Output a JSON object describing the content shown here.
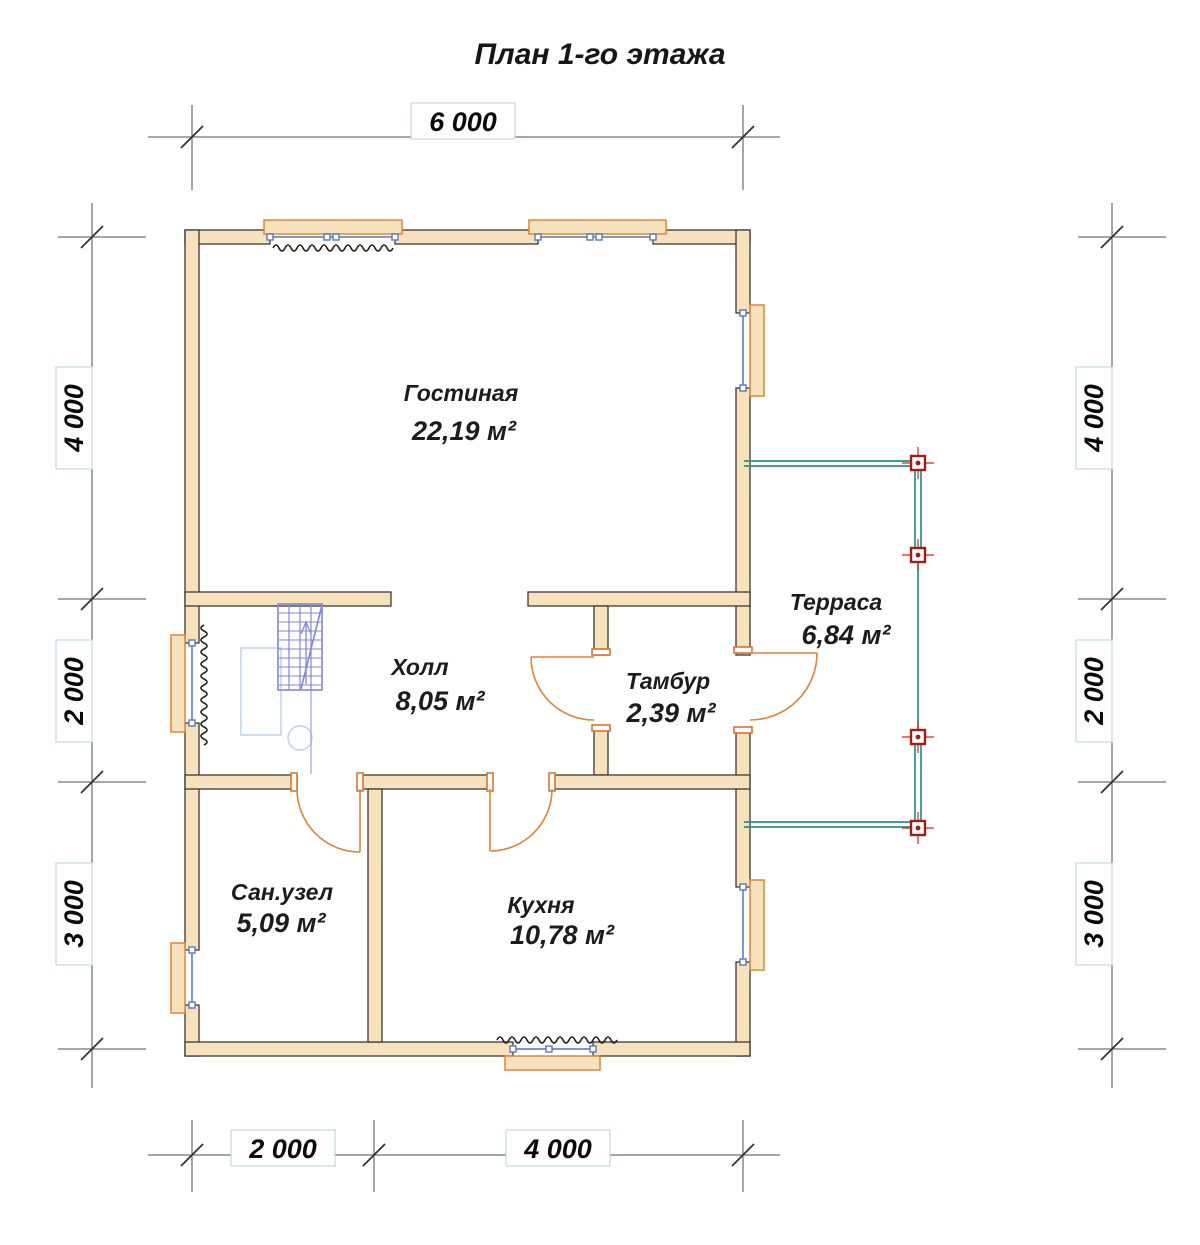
{
  "title": "План 1-го этажа",
  "rooms": {
    "living": {
      "name": "Гостиная",
      "area": "22,19 м²"
    },
    "hall": {
      "name": "Холл",
      "area": "8,05 м²"
    },
    "vestibule": {
      "name": "Тамбур",
      "area": "2,39 м²"
    },
    "terrace": {
      "name": "Терраса",
      "area": "6,84 м²"
    },
    "bathroom": {
      "name": "Сан.узел",
      "area": "5,09 м²"
    },
    "kitchen": {
      "name": "Кухня",
      "area": "10,78 м²"
    }
  },
  "dimensions": {
    "top": {
      "total": "6 000"
    },
    "bottom": {
      "left": "2 000",
      "right": "4 000"
    },
    "left": {
      "top": "4 000",
      "middle": "2 000",
      "bottom": "3 000"
    },
    "right": {
      "top": "4 000",
      "middle": "2 000",
      "bottom": "3 000"
    }
  },
  "legend_colors": {
    "wall_fill": "#f6e2bd",
    "wall_outline": "#3d3833",
    "window_glazing": "#7d99cc",
    "sill_and_door": "#e08438",
    "stairs": "#8288d4",
    "terrace": "#2a9183",
    "post": "#9c2016",
    "dimension_line": "#4d4d4d"
  }
}
